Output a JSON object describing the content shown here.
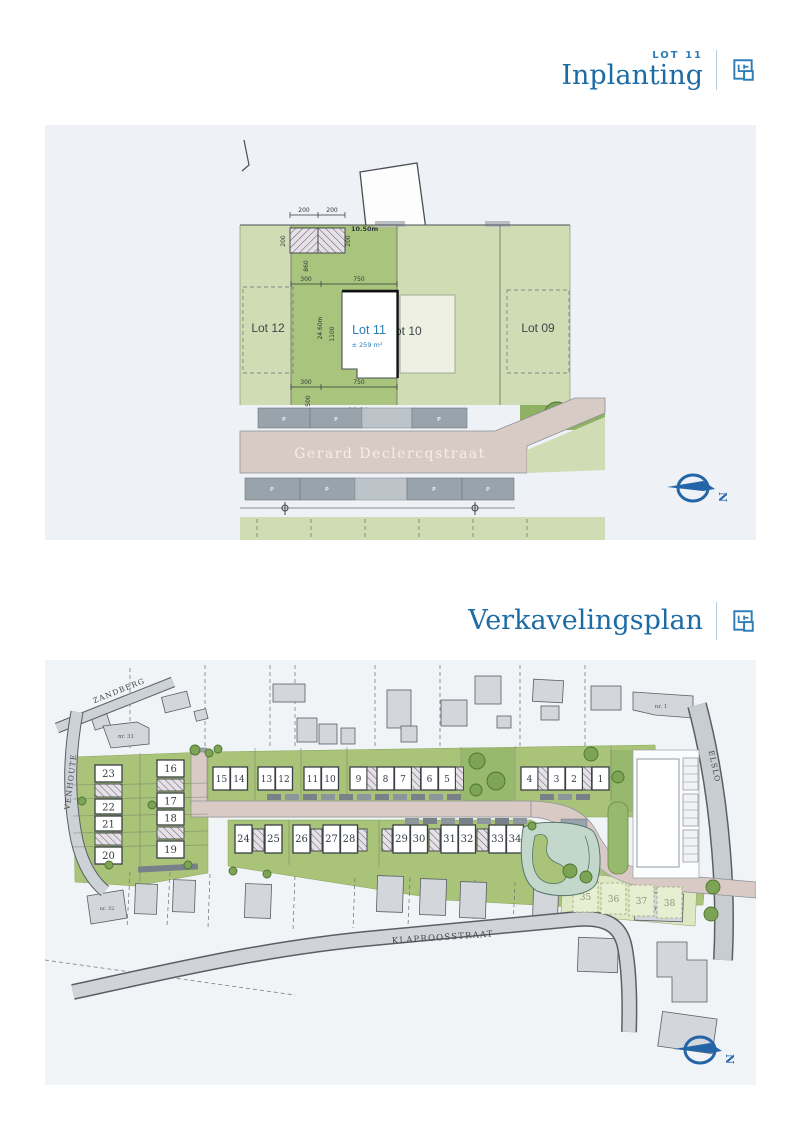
{
  "headers": {
    "inplanting": {
      "lot": "LOT 11",
      "title": "Inplanting"
    },
    "verkaveling": {
      "title": "Verkavelingsplan"
    }
  },
  "icons": {
    "floorplan_icon": "blueprint-page",
    "compass_icon": "north-arrow",
    "lamp_icon": "street-lamp"
  },
  "colors": {
    "accent_blue": "#2d7db8",
    "heading_blue": "#1c6ba4",
    "panel_bg": "#eef1f5",
    "lot_green_light": "#cfdcb4",
    "lot_green": "#a9c479",
    "road_pink": "#d9cac6"
  },
  "inplanting_plan": {
    "lot12": "Lot 12",
    "lot11": "Lot 11",
    "lot11_area": "± 259 m²",
    "lot10": "Lot 10",
    "lot09": "Lot 09",
    "street": "Gerard Declercqstraat",
    "parking": "P",
    "compass_n": "N",
    "dims": {
      "top_w1": "200",
      "top_w2": "200",
      "top_front": "10.50m",
      "side_l": "200",
      "side_r": "200",
      "d860": "860",
      "d300_top": "300",
      "d750_top": "750",
      "depth_left": "24.60m",
      "d1100": "1100",
      "depth_right": "24.78m",
      "d300_bot": "300",
      "d750_bot": "750",
      "d500": "500",
      "front_bot": "10.50m"
    }
  },
  "verkaveling_plan": {
    "streets": {
      "zandberg": "ZANDBERG",
      "venhoute": "VENHOUTE",
      "elslo": "ELSLO",
      "klaproosstraat": "KLAPROOSSTRAAT"
    },
    "house_numbers": {
      "nr31": "nr. 31",
      "nr32": "nr. 32",
      "nr1": "nr. 1",
      "nr22": "nr. 22"
    },
    "lot_numbers": [
      "1",
      "2",
      "3",
      "4",
      "5",
      "6",
      "7",
      "8",
      "9",
      "10",
      "11",
      "12",
      "13",
      "14",
      "15",
      "16",
      "17",
      "18",
      "19",
      "20",
      "21",
      "22",
      "23",
      "24",
      "25",
      "26",
      "27",
      "28",
      "29",
      "30",
      "31",
      "32",
      "33",
      "34",
      "35",
      "36",
      "37",
      "38"
    ],
    "compass_n": "N"
  }
}
